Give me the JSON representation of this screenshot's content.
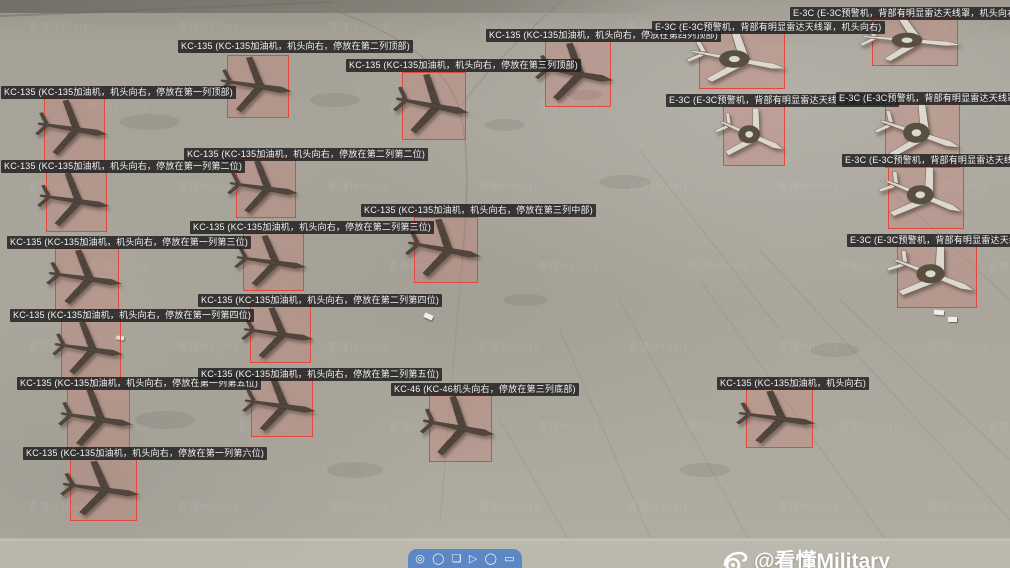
{
  "scene": {
    "credit": {
      "handle": "@看懂Military"
    },
    "watermark_tile": "看懂Military",
    "vehicles": [
      {
        "x": 424,
        "y": 314,
        "w": 9,
        "h": 5,
        "rot": 25
      },
      {
        "x": 934,
        "y": 310,
        "w": 10,
        "h": 5,
        "rot": 5
      },
      {
        "x": 948,
        "y": 317,
        "w": 9,
        "h": 5,
        "rot": 0
      },
      {
        "x": 116,
        "y": 336,
        "w": 8,
        "h": 4,
        "rot": 10
      }
    ]
  },
  "toolbar": {
    "icons": [
      {
        "name": "circle-tool-icon",
        "glyph": "◎"
      },
      {
        "name": "ellipse-tool-icon",
        "glyph": "◯"
      },
      {
        "name": "crop-tool-icon",
        "glyph": "❏"
      },
      {
        "name": "arrow-tool-icon",
        "glyph": "▷"
      },
      {
        "name": "oval-tool-icon",
        "glyph": "◯"
      },
      {
        "name": "rect-tool-icon",
        "glyph": "▭"
      }
    ]
  },
  "colors": {
    "box_stroke": "#e2483e",
    "box_fill": "rgba(231,96,85,0.18)",
    "label_bg": "rgba(33,33,33,0.85)",
    "label_fg": "#f2f2f2",
    "kc_fill": "#51463d",
    "e3c_fill": "#ddd8ce",
    "e3c_disc": "#57503f",
    "toolbar_bg": "#5b87c5"
  },
  "annotations": [
    {
      "id": 1,
      "type": "KC-135",
      "label": "KC-135 (KC-135加油机，机头向右，停放在第一列顶部)",
      "label_pos": {
        "x": 1,
        "y": 86
      },
      "box": {
        "x": 44,
        "y": 98,
        "w": 61,
        "h": 63
      },
      "rot": 10
    },
    {
      "id": 2,
      "type": "KC-135",
      "label": "KC-135 (KC-135加油机，机头向右，停放在第一列第二位)",
      "label_pos": {
        "x": 1,
        "y": 160
      },
      "box": {
        "x": 46,
        "y": 171,
        "w": 61,
        "h": 61
      },
      "rot": 10
    },
    {
      "id": 3,
      "type": "KC-135",
      "label": "KC-135 (KC-135加油机，机头向右，停放在第一列第三位)",
      "label_pos": {
        "x": 7,
        "y": 236
      },
      "box": {
        "x": 55,
        "y": 248,
        "w": 64,
        "h": 62
      },
      "rot": 10
    },
    {
      "id": 4,
      "type": "KC-135",
      "label": "KC-135 (KC-135加油机，机头向右，停放在第一列第四位)",
      "label_pos": {
        "x": 10,
        "y": 309
      },
      "box": {
        "x": 61,
        "y": 319,
        "w": 60,
        "h": 60
      },
      "rot": 10
    },
    {
      "id": 5,
      "type": "KC-135",
      "label": "KC-135 (KC-135加油机，机头向右，停放在第一列第五位)",
      "label_pos": {
        "x": 17,
        "y": 377
      },
      "box": {
        "x": 67,
        "y": 387,
        "w": 63,
        "h": 65
      },
      "rot": 10
    },
    {
      "id": 6,
      "type": "KC-135",
      "label": "KC-135 (KC-135加油机，机头向右，停放在第一列第六位)",
      "label_pos": {
        "x": 23,
        "y": 447
      },
      "box": {
        "x": 70,
        "y": 459,
        "w": 67,
        "h": 62
      },
      "rot": 10
    },
    {
      "id": 7,
      "type": "KC-135",
      "label": "KC-135 (KC-135加油机，机头向右，停放在第二列顶部)",
      "label_pos": {
        "x": 178,
        "y": 40
      },
      "box": {
        "x": 227,
        "y": 55,
        "w": 62,
        "h": 63
      },
      "rot": 10
    },
    {
      "id": 8,
      "type": "KC-135",
      "label": "KC-135 (KC-135加油机，机头向右，停放在第二列第二位)",
      "label_pos": {
        "x": 184,
        "y": 148
      },
      "box": {
        "x": 236,
        "y": 158,
        "w": 60,
        "h": 60
      },
      "rot": 10
    },
    {
      "id": 9,
      "type": "KC-135",
      "label": "KC-135 (KC-135加油机，机头向右，停放在第二列第三位)",
      "label_pos": {
        "x": 190,
        "y": 221
      },
      "box": {
        "x": 243,
        "y": 233,
        "w": 61,
        "h": 58
      },
      "rot": 10
    },
    {
      "id": 10,
      "type": "KC-135",
      "label": "KC-135 (KC-135加油机，机头向右，停放在第二列第四位)",
      "label_pos": {
        "x": 198,
        "y": 294
      },
      "box": {
        "x": 250,
        "y": 305,
        "w": 61,
        "h": 58
      },
      "rot": 10
    },
    {
      "id": 11,
      "type": "KC-135",
      "label": "KC-135 (KC-135加油机，机头向右，停放在第二列第五位)",
      "label_pos": {
        "x": 198,
        "y": 368
      },
      "box": {
        "x": 251,
        "y": 376,
        "w": 62,
        "h": 61
      },
      "rot": 10
    },
    {
      "id": 12,
      "type": "KC-135",
      "label": "KC-135 (KC-135加油机，机头向右，停放在第三列顶部)",
      "label_pos": {
        "x": 346,
        "y": 59
      },
      "box": {
        "x": 402,
        "y": 72,
        "w": 64,
        "h": 68
      },
      "rot": 12
    },
    {
      "id": 13,
      "type": "KC-135",
      "label": "KC-135 (KC-135加油机，机头向右，停放在第三列中部)",
      "label_pos": {
        "x": 361,
        "y": 204
      },
      "box": {
        "x": 414,
        "y": 217,
        "w": 64,
        "h": 66
      },
      "rot": 12
    },
    {
      "id": 14,
      "type": "KC-46",
      "label": "KC-46 (KC-46机头向右，停放在第三列底部)",
      "label_pos": {
        "x": 391,
        "y": 383
      },
      "box": {
        "x": 429,
        "y": 394,
        "w": 63,
        "h": 68
      },
      "rot": 12
    },
    {
      "id": 15,
      "type": "KC-135",
      "label": "KC-135 (KC-135加油机，机头向右，停放在第四列顶部)",
      "label_pos": {
        "x": 486,
        "y": 29
      },
      "box": {
        "x": 545,
        "y": 41,
        "w": 66,
        "h": 66
      },
      "rot": 12
    },
    {
      "id": 16,
      "type": "E-3C",
      "label": "E-3C (E-3C预警机，背部有明显雷达天线罩，机头向右)",
      "label_pos": {
        "x": 652,
        "y": 21
      },
      "box": {
        "x": 699,
        "y": 31,
        "w": 86,
        "h": 58
      },
      "rot": 18
    },
    {
      "id": 17,
      "type": "E-3C",
      "label": "E-3C (E-3C预警机，背部有明显雷达天线罩，机头向右)",
      "label_pos": {
        "x": 790,
        "y": 7
      },
      "box": {
        "x": 872,
        "y": 16,
        "w": 86,
        "h": 50
      },
      "rot": 10
    },
    {
      "id": 18,
      "type": "E-3C",
      "label": "E-3C (E-3C预警机，背部有明显雷达天线罩，机头向右)",
      "label_pos": {
        "x": 666,
        "y": 94
      },
      "box": {
        "x": 723,
        "y": 106,
        "w": 62,
        "h": 60
      },
      "rot": 28
    },
    {
      "id": 19,
      "type": "E-3C",
      "label": "E-3C (E-3C预警机，背部有明显雷达天线罩，机头向右)",
      "label_pos": {
        "x": 836,
        "y": 92
      },
      "box": {
        "x": 885,
        "y": 102,
        "w": 75,
        "h": 66
      },
      "rot": 24
    },
    {
      "id": 20,
      "type": "E-3C",
      "label": "E-3C (E-3C预警机，背部有明显雷达天线罩，机头向右)",
      "label_pos": {
        "x": 842,
        "y": 154
      },
      "box": {
        "x": 888,
        "y": 166,
        "w": 76,
        "h": 63
      },
      "rot": 30
    },
    {
      "id": 21,
      "type": "E-3C",
      "label": "E-3C (E-3C预警机，背部有明显雷达天线罩，机头向右)",
      "label_pos": {
        "x": 847,
        "y": 234
      },
      "box": {
        "x": 897,
        "y": 245,
        "w": 80,
        "h": 63
      },
      "rot": 30
    },
    {
      "id": 22,
      "type": "KC-135",
      "label": "KC-135 (KC-135加油机，机头向右)",
      "label_pos": {
        "x": 717,
        "y": 377
      },
      "box": {
        "x": 746,
        "y": 388,
        "w": 67,
        "h": 60
      },
      "rot": 10
    }
  ]
}
